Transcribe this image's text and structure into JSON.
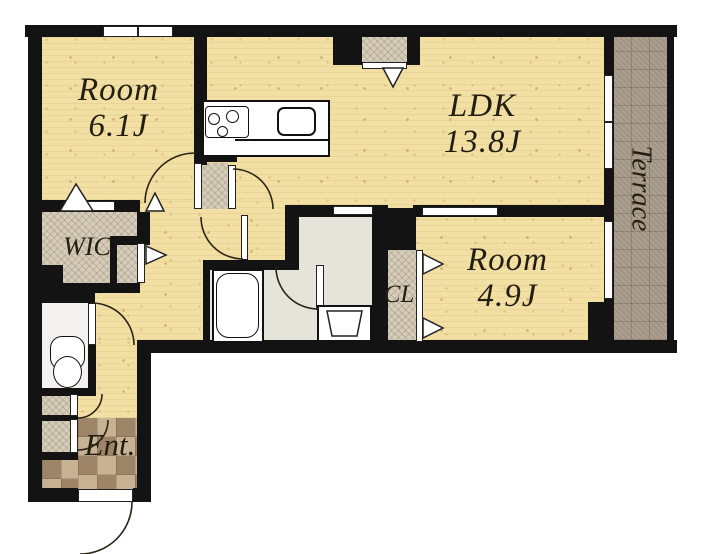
{
  "plan": {
    "title": "apartment floor plan",
    "rooms": {
      "room1": {
        "name": "Room",
        "size": "6.1J"
      },
      "ldk": {
        "name": "LDK",
        "size": "13.8J"
      },
      "room2": {
        "name": "Room",
        "size": "4.9J"
      },
      "wic": {
        "label": "WIC"
      },
      "cl": {
        "label": "CL"
      },
      "entrance": {
        "label": "Ent."
      },
      "terrace": {
        "label": "Terrace"
      }
    },
    "colors": {
      "wood_floor": "#f2dfa3",
      "closet_hatch": "#d5ccba",
      "terrace_tile": "#a89a8a",
      "entrance_tile_light": "#c8b294",
      "entrance_tile_dark": "#9e8568",
      "wet_area_floor": "#e6e3db",
      "toilet_floor": "#f3f2ee",
      "wall": "#131313",
      "text": "#221e12"
    }
  }
}
